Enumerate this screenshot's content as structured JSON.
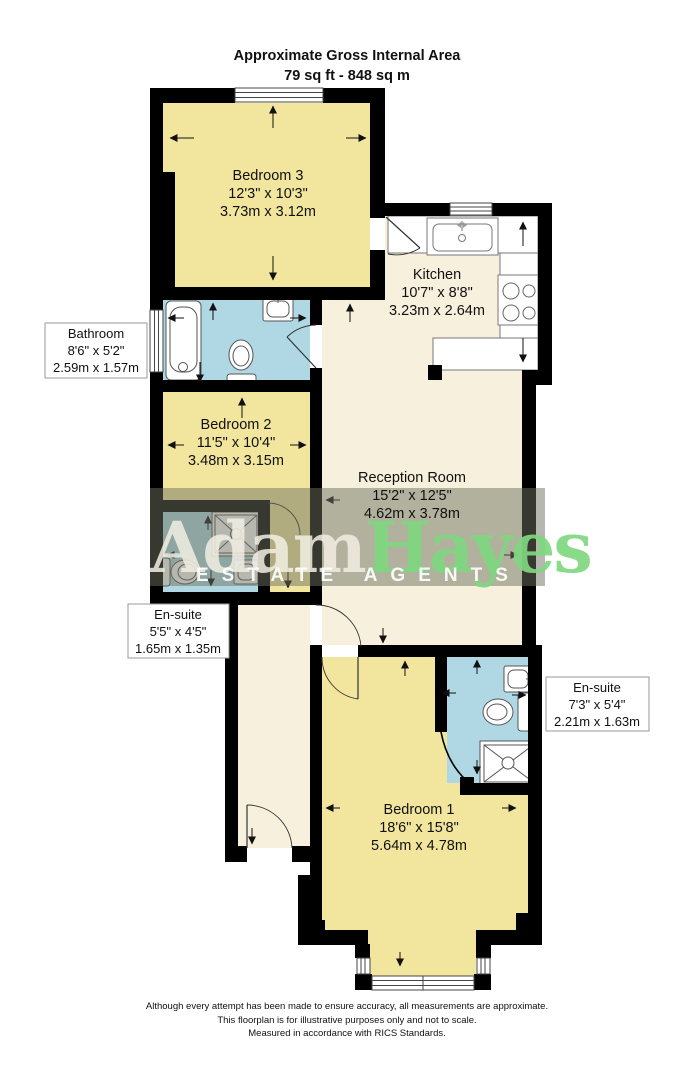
{
  "header": {
    "line1": "Approximate Gross Internal Area",
    "line2": "79 sq ft - 848 sq m"
  },
  "rooms": {
    "bedroom3": {
      "name": "Bedroom 3",
      "imperial": "12'3\" x 10'3\"",
      "metric": "3.73m x 3.12m"
    },
    "kitchen": {
      "name": "Kitchen",
      "imperial": "10'7\" x 8'8\"",
      "metric": "3.23m x 2.64m"
    },
    "bathroom": {
      "name": "Bathroom",
      "imperial": "8'6\" x 5'2\"",
      "metric": "2.59m x 1.57m"
    },
    "bedroom2": {
      "name": "Bedroom 2",
      "imperial": "11'5\" x 10'4\"",
      "metric": "3.48m x 3.15m"
    },
    "reception": {
      "name": "Reception Room",
      "imperial": "15'2\" x 12'5\"",
      "metric": "4.62m x 3.78m"
    },
    "ensuite_left": {
      "name": "En-suite",
      "imperial": "5'5\" x 4'5\"",
      "metric": "1.65m x 1.35m"
    },
    "ensuite_right": {
      "name": "En-suite",
      "imperial": "7'3\" x 5'4\"",
      "metric": "2.21m x 1.63m"
    },
    "bedroom1": {
      "name": "Bedroom 1",
      "imperial": "18'6\" x 15'8\"",
      "metric": "5.64m x 4.78m"
    }
  },
  "watermark": {
    "brand_first": "Adam",
    "brand_second": "Hayes",
    "tagline": "ESTATE AGENTS"
  },
  "footer": {
    "line1": "Although every attempt has been made to ensure accuracy, all measurements are approximate.",
    "line2": "This floorplan is for illustrative purposes only and not to scale.",
    "line3": "Measured in accordance with RICS Standards."
  },
  "colors": {
    "wall": "#000000",
    "room_yellow": "#F2E69E",
    "room_cream": "#F7F0DC",
    "room_blue": "#AFD8E4",
    "brand_green": "#7FD880",
    "brand_white": "#F2EFE3",
    "watermark_band": "#6E7260"
  }
}
